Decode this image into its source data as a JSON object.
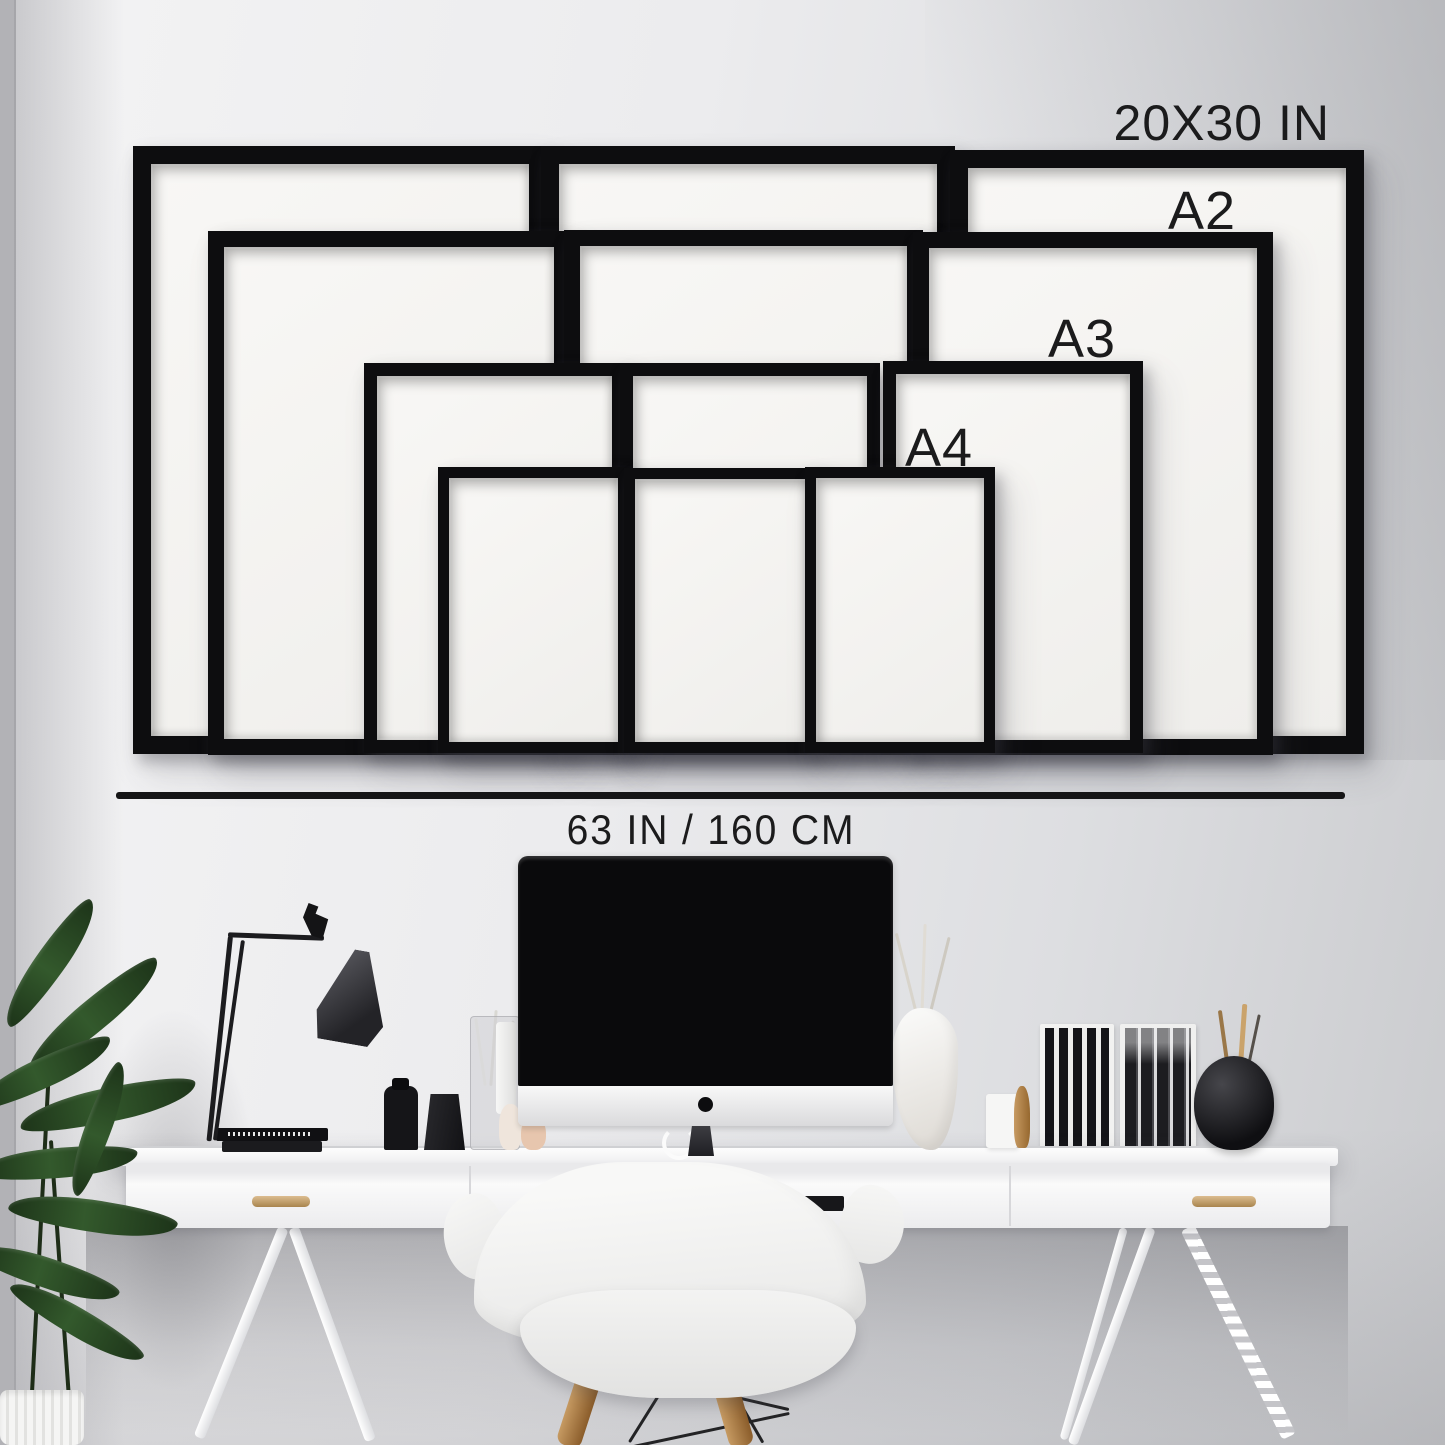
{
  "size_guide": {
    "labels": {
      "largest": "20X30 IN",
      "a2": "A2",
      "a3": "A3",
      "a4": "A4"
    },
    "wall_width": "63 IN / 160 CM",
    "frame_color": "#0d0d0f",
    "mat_color": "#f6f5f2",
    "frame_sizes_shown": [
      "20X30 IN",
      "A2",
      "A3",
      "A4"
    ],
    "frames_per_size": 3
  },
  "scene": {
    "wall_color": "#e9eaec",
    "ruler_color": "#151516",
    "desk_color": "#fafafa",
    "handle_color": "#c89f6e",
    "plant_color": "#2c4a27",
    "objects": [
      "picture-frames",
      "measuring-line",
      "desk-lamp",
      "imac-computer",
      "glass-vase",
      "black-bottles",
      "white-sculpture-vase",
      "magazine-files",
      "black-round-vase",
      "shell-chair",
      "potted-plant",
      "white-desk"
    ]
  }
}
